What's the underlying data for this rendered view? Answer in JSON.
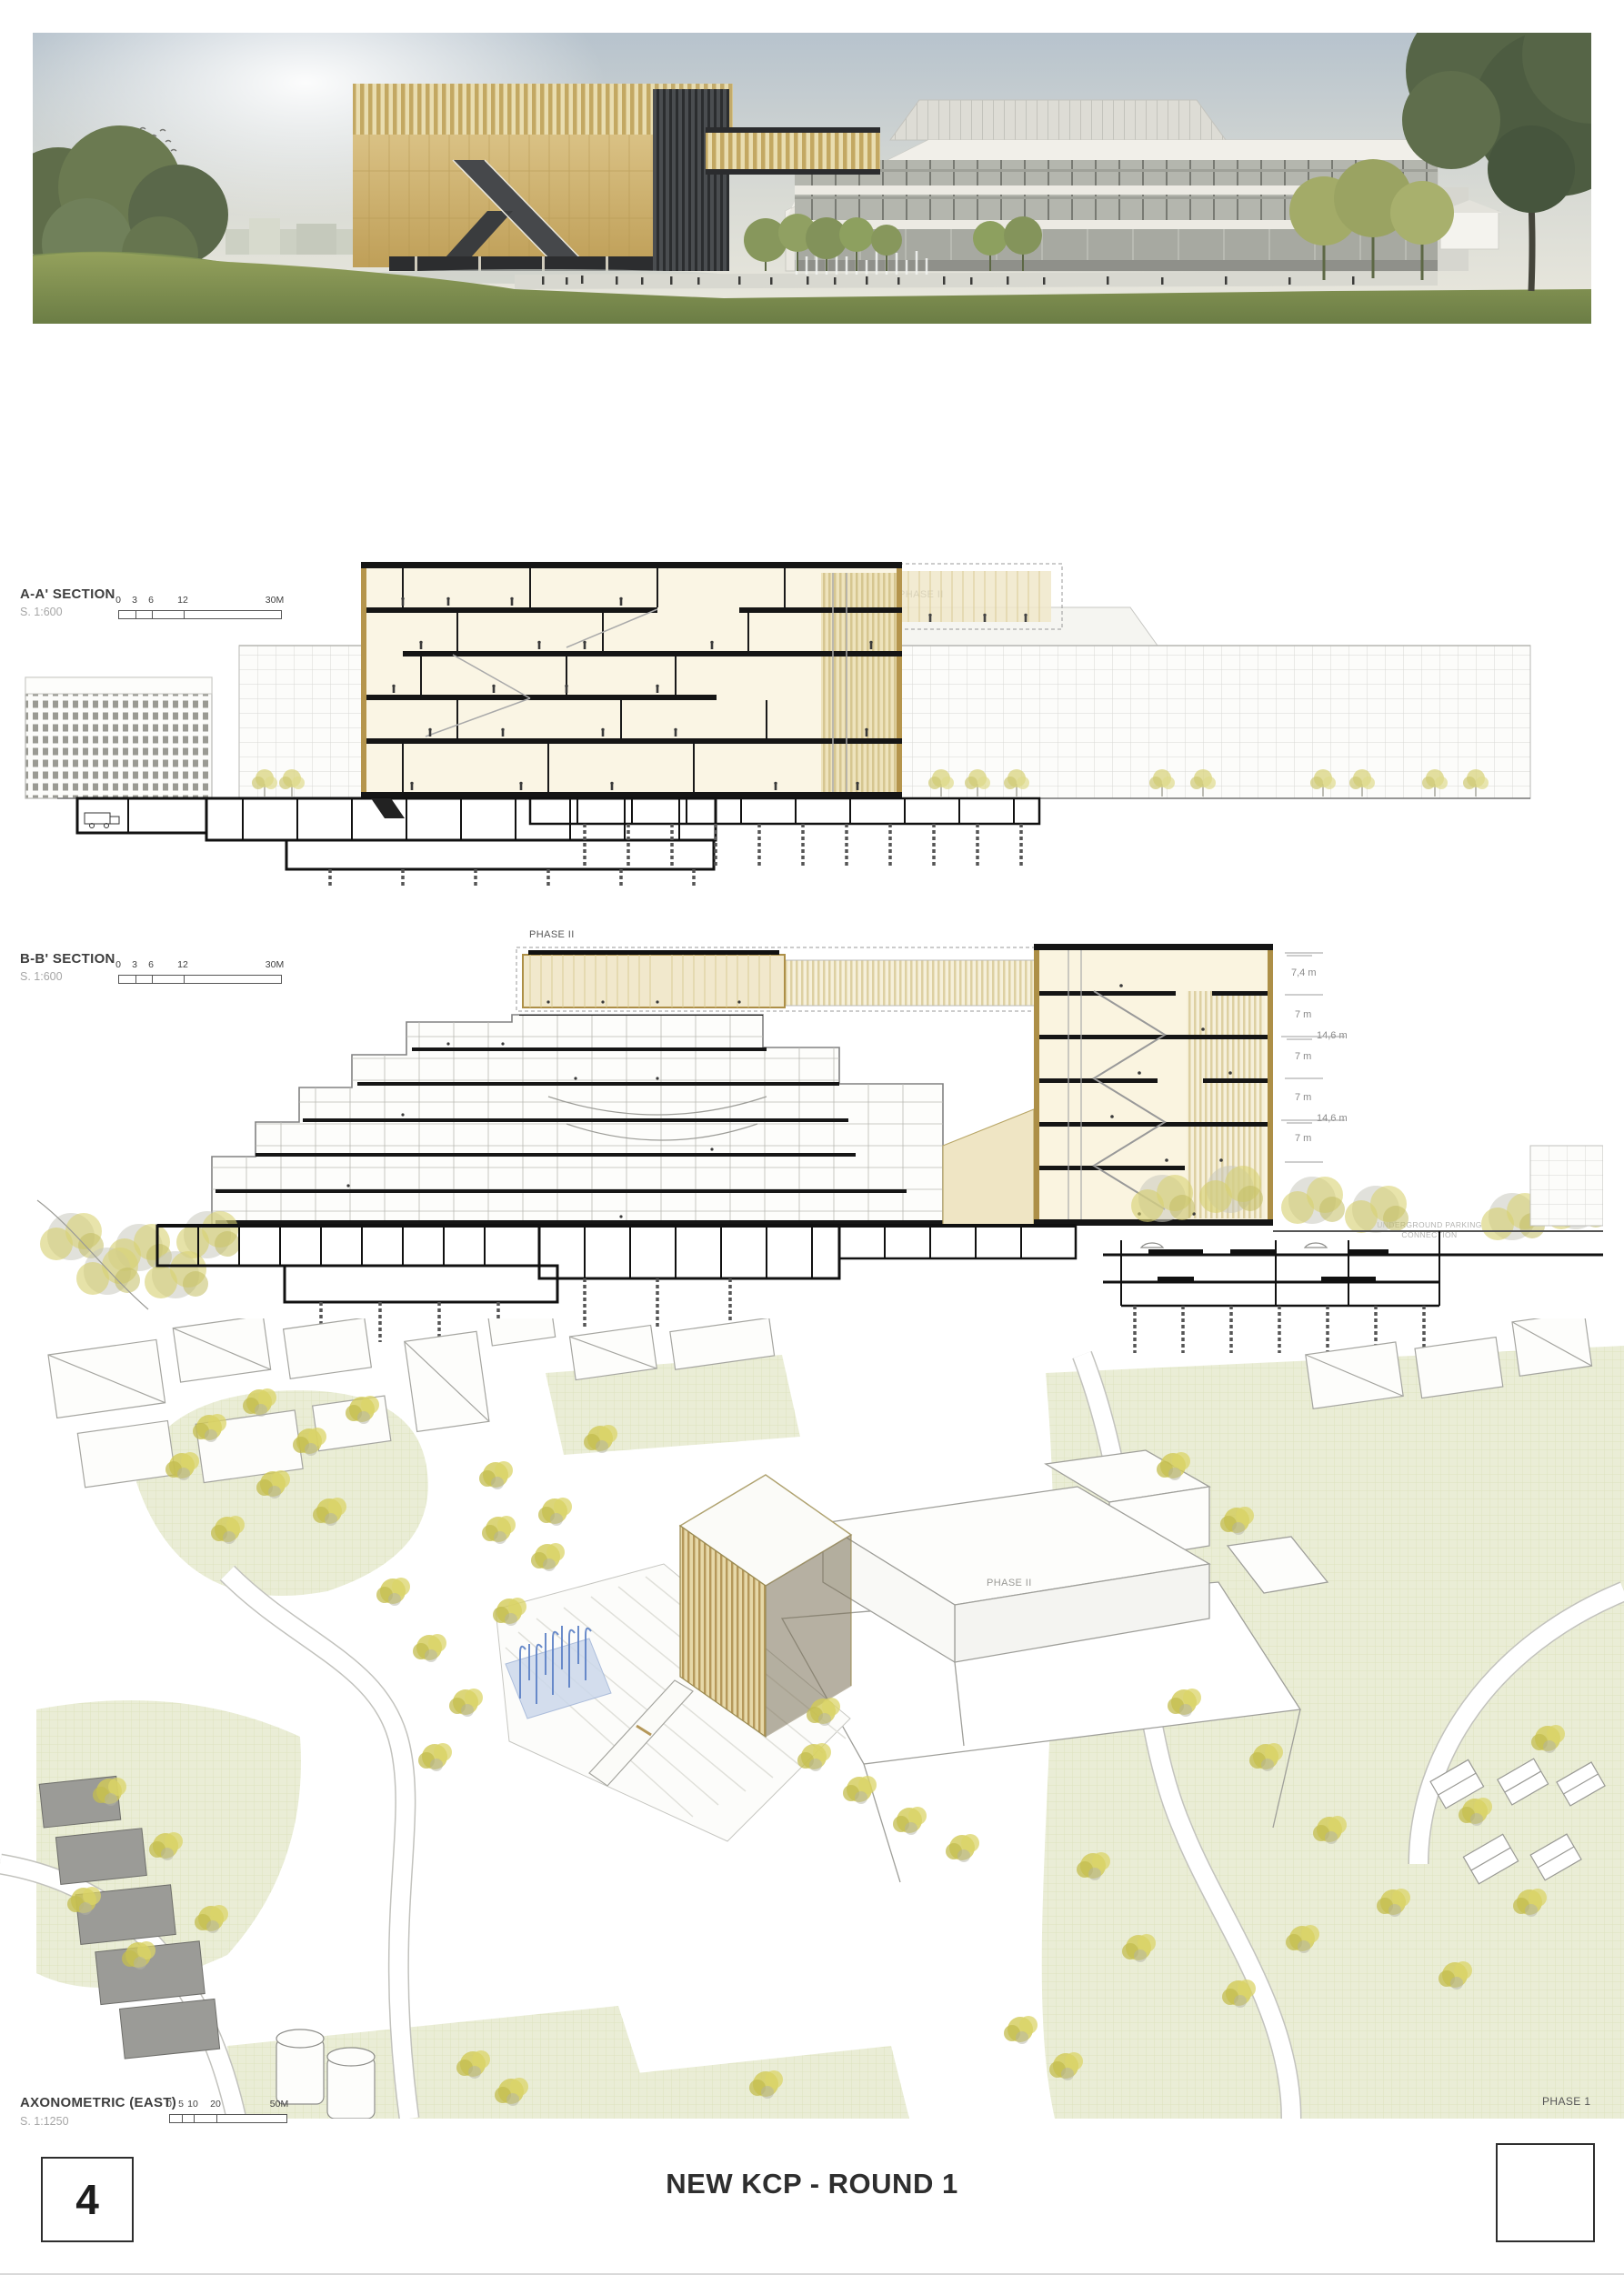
{
  "board": {
    "title": "NEW KCP - ROUND 1",
    "page_number": "4",
    "corner_phase_label": "PHASE 1"
  },
  "section_aa": {
    "label": "A-A' SECTION",
    "scale": "S. 1:600",
    "scalebar_ticks": [
      "0",
      "3",
      "6",
      "12",
      "30M"
    ],
    "phase_label": "PHASE II",
    "hotel_sign": "Holiday Inn",
    "hotel_logo_letter": "H"
  },
  "section_bb": {
    "label": "B-B' SECTION",
    "scale": "S. 1:600",
    "scalebar_ticks": [
      "0",
      "3",
      "6",
      "12",
      "30M"
    ],
    "phase_label": "PHASE II",
    "dim_labels": [
      "7,4 m",
      "7 m",
      "14,6 m",
      "7 m",
      "7 m",
      "14,6 m",
      "7 m"
    ],
    "underground_note": [
      "UNDERGROUND PARKING",
      "CONNECTION"
    ]
  },
  "axonometric": {
    "label": "AXONOMETRIC (EAST)",
    "scale": "S. 1:1250",
    "scalebar_ticks": [
      "0",
      "5",
      "10",
      "20",
      "50M"
    ],
    "phase_label": "PHASE II"
  },
  "colors": {
    "facade_gold": "#c9ab62",
    "section_beige": "#faf4e2",
    "gold_edge": "#ad8f47",
    "tree_yellow": "#d6d06b",
    "park_green": "#e9ecd3",
    "fountain_blue": "#5b7fc4",
    "ink": "#161616",
    "grey_line": "#a5a5a0"
  }
}
